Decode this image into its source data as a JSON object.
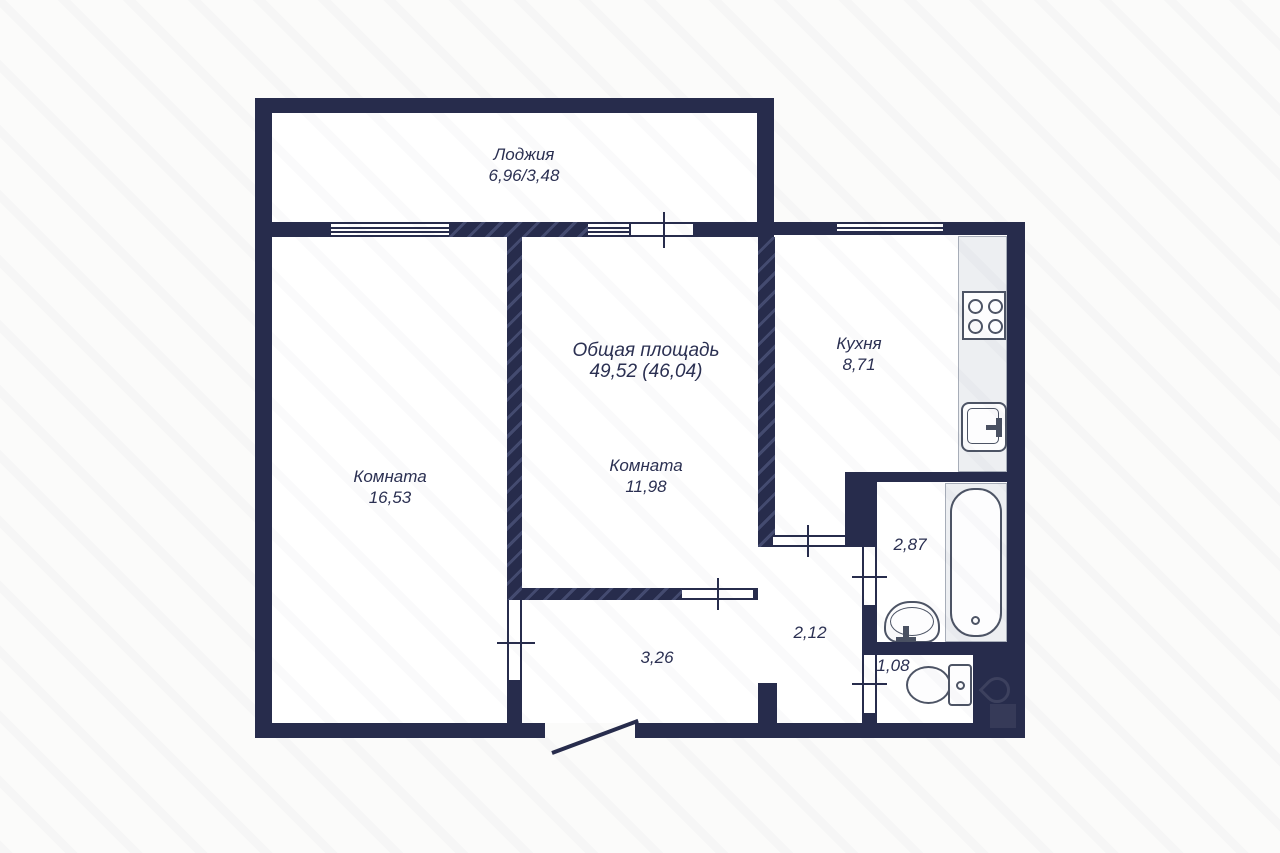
{
  "plan": {
    "loggia": {
      "label": "Лоджия",
      "area": "6,96/3,48"
    },
    "room_left": {
      "label": "Комната",
      "area": "16,53"
    },
    "total": {
      "label": "Общая площадь",
      "value": "49,52 (46,04)"
    },
    "room_middle": {
      "label": "Комната",
      "area": "11,98"
    },
    "kitchen": {
      "label": "Кухня",
      "area": "8,71"
    },
    "bathroom": {
      "area": "2,87"
    },
    "corridor": {
      "area": "2,12"
    },
    "hallway": {
      "area": "3,26"
    },
    "wc": {
      "area": "1,08"
    },
    "fixtures": [
      "kitchen-counter",
      "kitchen-stove",
      "kitchen-sink",
      "bathtub",
      "bathroom-sink",
      "toilet",
      "entrance-door"
    ],
    "colors": {
      "wall": "#272c4c",
      "wall_hatch": "#444b70",
      "background": "#fbfbfa",
      "room_fill": "#ffffff",
      "fixture_fill": "#edeff2",
      "fixture_outline": "#4d5465",
      "text": "#2b3052"
    }
  }
}
